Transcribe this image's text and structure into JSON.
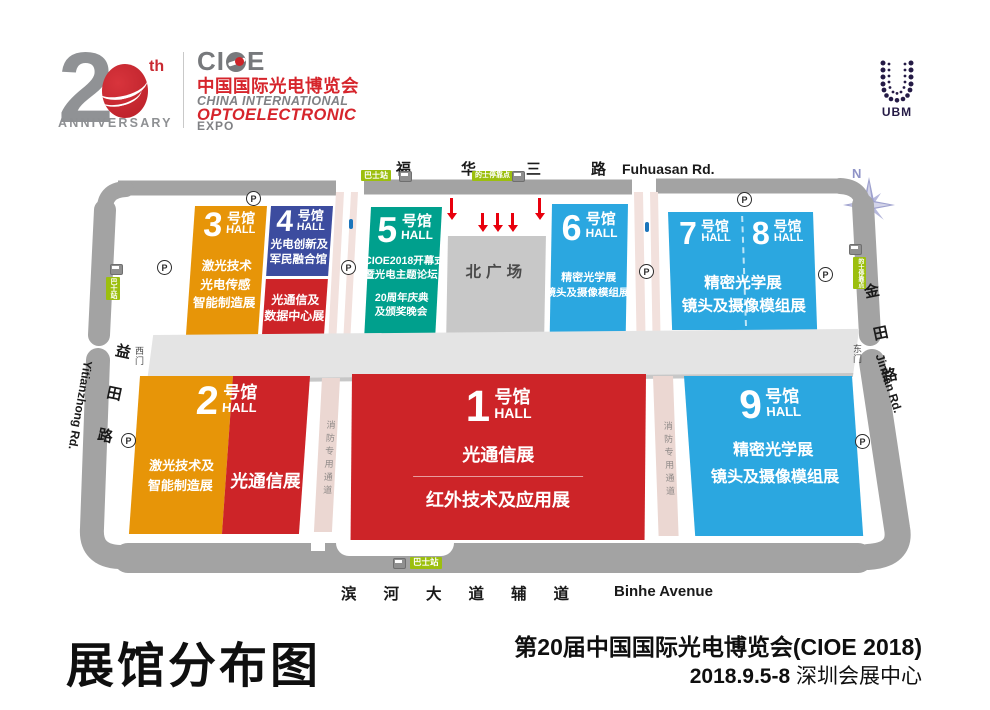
{
  "header": {
    "anniversary": {
      "num2": "2",
      "th": "th",
      "label": "ANNIVERSARY"
    },
    "cioe": {
      "part1": "CI",
      "part2": "E",
      "cn": "中国国际光电博览会",
      "en1": "CHINA INTERNATIONAL",
      "en2": "OPTOELECTRONIC",
      "en3": "EXPO"
    },
    "ubm": "UBM",
    "compass": "N"
  },
  "roads": {
    "top_cn": "福华三路",
    "top_en": "Fuhuasan Rd.",
    "bottom_cn": "滨河大道辅道",
    "bottom_en": "Binhe Avenue",
    "left_cn": "益田路",
    "left_en": "Yitianzhong Rd.",
    "right_cn": "金田路",
    "right_en": "Jintian Rd."
  },
  "gates": {
    "west": "西门",
    "east": "东门"
  },
  "badges": {
    "bus": "巴士站",
    "taxi": "的士停靠点"
  },
  "markers": {
    "parking": "P",
    "info": "i"
  },
  "plaza": {
    "north_square": "北广场"
  },
  "fire_lane": "消防专用通道",
  "halls": {
    "h1": {
      "num": "1",
      "suffix": "号馆",
      "hall": "HALL",
      "line1": "光通信展",
      "line2": "红外技术及应用展"
    },
    "h2": {
      "num": "2",
      "suffix": "号馆",
      "hall": "HALL",
      "left1": "激光技术及",
      "left2": "智能制造展",
      "right1": "光通信展"
    },
    "h3": {
      "num": "3",
      "suffix": "号馆",
      "hall": "HALL",
      "line1": "激光技术",
      "line2": "光电传感",
      "line3": "智能制造展"
    },
    "h4": {
      "num": "4",
      "suffix": "号馆",
      "hall": "HALL",
      "top1": "光电创新及",
      "top2": "军民融合馆",
      "bot1": "光通信及",
      "bot2": "数据中心展"
    },
    "h5": {
      "num": "5",
      "suffix": "号馆",
      "hall": "HALL",
      "line1": "CIOE2018开幕式",
      "line2": "暨光电主题论坛",
      "line3": "20周年庆典",
      "line4": "及颁奖晚会"
    },
    "h6": {
      "num": "6",
      "suffix": "号馆",
      "hall": "HALL",
      "line1": "精密光学展",
      "line2": "镜头及摄像模组展"
    },
    "h7": {
      "num": "7",
      "suffix": "号馆",
      "hall": "HALL"
    },
    "h8": {
      "num": "8",
      "suffix": "号馆",
      "hall": "HALL"
    },
    "h78": {
      "line1": "精密光学展",
      "line2": "镜头及摄像模组展"
    },
    "h9": {
      "num": "9",
      "suffix": "号馆",
      "hall": "HALL",
      "line1": "精密光学展",
      "line2": "镜头及摄像模组展"
    }
  },
  "footer": {
    "map_title": "展馆分布图",
    "event_title": "第20届中国国际光电博览会(CIOE 2018)",
    "date": "2018.9.5-8",
    "venue": "深圳会展中心"
  },
  "colors": {
    "orange": "#E79508",
    "red": "#CD2428",
    "navy": "#3C4C9F",
    "teal": "#00A08D",
    "blue": "#2BA7E0",
    "road": "#A3A3A3",
    "band": "#E4E4E4",
    "square": "#C8C8C8",
    "badge_green": "#9CBF0E",
    "arrow_red": "#E8000D",
    "brand_red": "#D6252C"
  }
}
